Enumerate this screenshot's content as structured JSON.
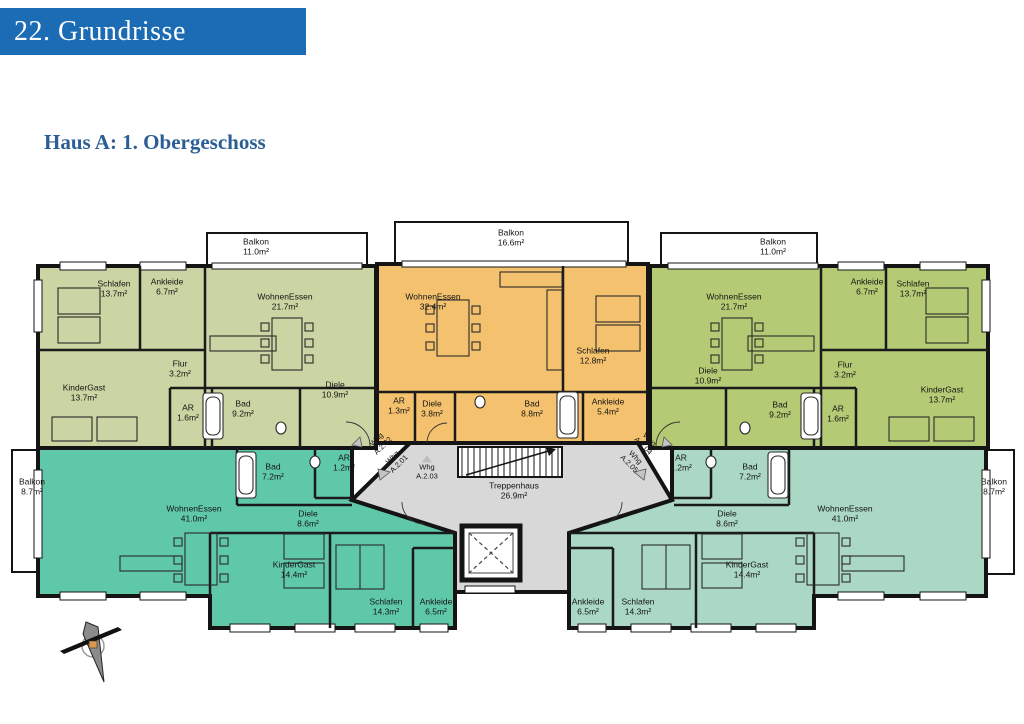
{
  "header": {
    "title": "22. Grundrisse",
    "subtitle": "Haus A: 1. Obergeschoss"
  },
  "colors": {
    "header_bar_blue": "#1b6cb4",
    "subtitle_blue": "#2b5f93",
    "wall_black": "#141414",
    "stairwell_gray": "#d8d8d8",
    "unit_a201_teal": "#5fc8a9",
    "unit_a202_sage": "#cbd4a3",
    "unit_a203_orange": "#f4c26e",
    "unit_a204_green": "#b5ca74",
    "unit_a205_seafoam": "#aad8c4"
  },
  "units": [
    {
      "id": "A.2.01",
      "entrance_label": "Whg A.2.01",
      "color": "#5fc8a9",
      "rooms": [
        {
          "name": "WohnenEssen",
          "area": "41.0m²"
        },
        {
          "name": "Bad",
          "area": "7.2m²"
        },
        {
          "name": "AR",
          "area": "1.2m²"
        },
        {
          "name": "Diele",
          "area": "8.6m²"
        },
        {
          "name": "KinderGast",
          "area": "14.4m²"
        },
        {
          "name": "Schlafen",
          "area": "14.3m²"
        },
        {
          "name": "Ankleide",
          "area": "6.5m²"
        },
        {
          "name": "Balkon",
          "area": "8.7m²"
        }
      ]
    },
    {
      "id": "A.2.02",
      "entrance_label": "Whg A.2.02",
      "color": "#cbd4a3",
      "rooms": [
        {
          "name": "Schlafen",
          "area": "13.7m²"
        },
        {
          "name": "Ankleide",
          "area": "6.7m²"
        },
        {
          "name": "WohnenEssen",
          "area": "21.7m²"
        },
        {
          "name": "Flur",
          "area": "3.2m²"
        },
        {
          "name": "KinderGast",
          "area": "13.7m²"
        },
        {
          "name": "AR",
          "area": "1.6m²"
        },
        {
          "name": "Bad",
          "area": "9.2m²"
        },
        {
          "name": "Diele",
          "area": "10.9m²"
        },
        {
          "name": "Balkon",
          "area": "11.0m²"
        }
      ]
    },
    {
      "id": "A.2.03",
      "entrance_label": "Whg A.2.03",
      "color": "#f4c26e",
      "rooms": [
        {
          "name": "WohnenEssen",
          "area": "32.4m²"
        },
        {
          "name": "Schlafen",
          "area": "12.8m²"
        },
        {
          "name": "AR",
          "area": "1.3m²"
        },
        {
          "name": "Diele",
          "area": "3.8m²"
        },
        {
          "name": "Bad",
          "area": "8.8m²"
        },
        {
          "name": "Ankleide",
          "area": "5.4m²"
        },
        {
          "name": "Balkon",
          "area": "16.6m²"
        }
      ]
    },
    {
      "id": "A.2.04",
      "entrance_label": "Whg A.2.04",
      "color": "#b5ca74",
      "rooms": [
        {
          "name": "WohnenEssen",
          "area": "21.7m²"
        },
        {
          "name": "Ankleide",
          "area": "6.7m²"
        },
        {
          "name": "Schlafen",
          "area": "13.7m²"
        },
        {
          "name": "Diele",
          "area": "10.9m²"
        },
        {
          "name": "Flur",
          "area": "3.2m²"
        },
        {
          "name": "Bad",
          "area": "9.2m²"
        },
        {
          "name": "AR",
          "area": "1.6m²"
        },
        {
          "name": "KinderGast",
          "area": "13.7m²"
        },
        {
          "name": "Balkon",
          "area": "11.0m²"
        }
      ]
    },
    {
      "id": "A.2.05",
      "entrance_label": "Whg A.2.05",
      "color": "#aad8c4",
      "rooms": [
        {
          "name": "AR",
          "area": "1.2m²"
        },
        {
          "name": "Bad",
          "area": "7.2m²"
        },
        {
          "name": "Diele",
          "area": "8.6m²"
        },
        {
          "name": "WohnenEssen",
          "area": "41.0m²"
        },
        {
          "name": "KinderGast",
          "area": "14.4m²"
        },
        {
          "name": "Schlafen",
          "area": "14.3m²"
        },
        {
          "name": "Ankleide",
          "area": "6.5m²"
        },
        {
          "name": "Balkon",
          "area": "8.7m²"
        }
      ]
    }
  ],
  "common": {
    "stairwell_name": "Treppenhaus",
    "stairwell_area": "26.9m²"
  }
}
